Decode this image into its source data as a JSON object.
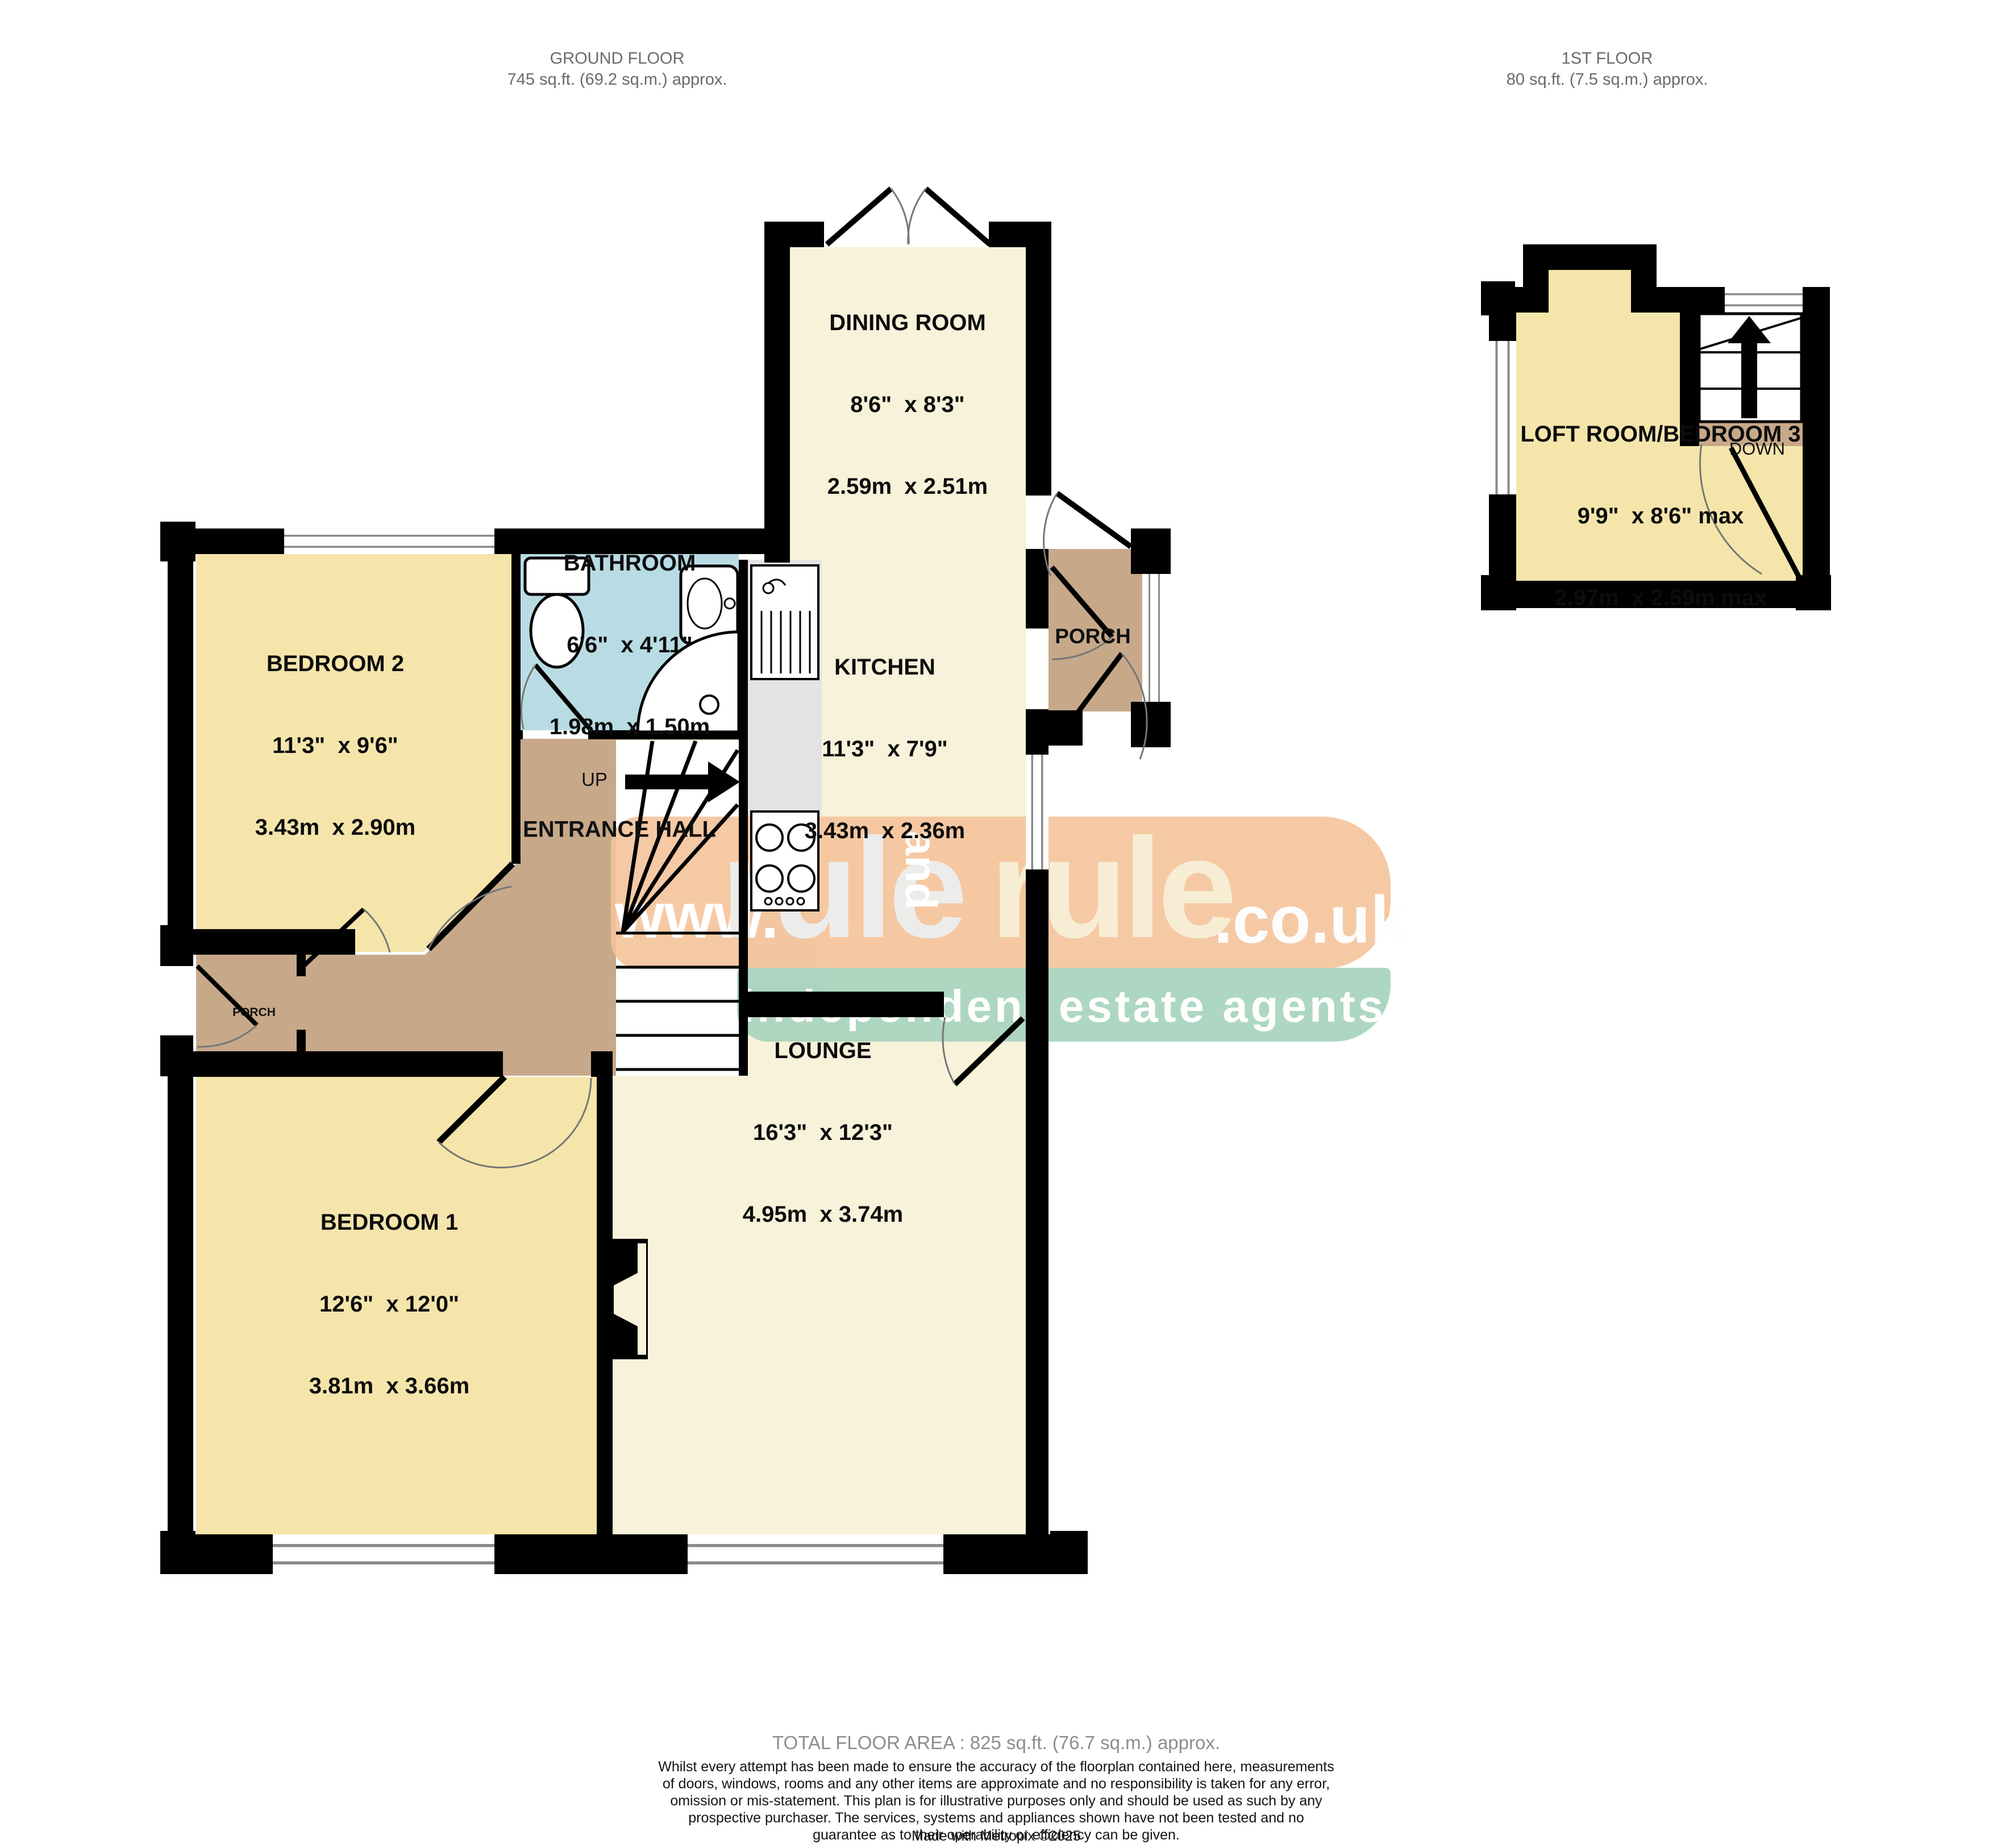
{
  "headers": {
    "ground": {
      "title": "GROUND FLOOR",
      "area": "745 sq.ft. (69.2 sq.m.) approx."
    },
    "first": {
      "title": "1ST FLOOR",
      "area": "80 sq.ft. (7.5 sq.m.) approx."
    }
  },
  "rooms": {
    "dining": {
      "name": "DINING ROOM",
      "imperial": "8'6\"  x 8'3\"",
      "metric": "2.59m  x 2.51m"
    },
    "kitchen": {
      "name": "KITCHEN",
      "imperial": "11'3\"  x 7'9\"",
      "metric": "3.43m  x 2.36m"
    },
    "bathroom": {
      "name": "BATHROOM",
      "imperial": "6'6\"  x 4'11\"",
      "metric": "1.98m  x 1.50m"
    },
    "bedroom2": {
      "name": "BEDROOM 2",
      "imperial": "11'3\"  x 9'6\"",
      "metric": "3.43m  x 2.90m"
    },
    "bedroom1": {
      "name": "BEDROOM 1",
      "imperial": "12'6\"  x 12'0\"",
      "metric": "3.81m  x 3.66m"
    },
    "lounge": {
      "name": "LOUNGE",
      "imperial": "16'3\"  x 12'3\"",
      "metric": "4.95m  x 3.74m"
    },
    "loft": {
      "name": "LOFT ROOM/BEDROOM 3",
      "imperial": "9'9\"  x 8'6\" max",
      "metric": "2.97m  x 2.59m max"
    },
    "entrance_hall": {
      "name": "ENTRANCE HALL"
    },
    "porch_right": {
      "name": "PORCH"
    },
    "porch_left": {
      "name": "PORCH"
    }
  },
  "stairs": {
    "up": "UP",
    "down": "DOWN"
  },
  "watermark": {
    "www": "www.",
    "rule1": "rule",
    "and": "and",
    "rule2": "rule",
    "domain": ".co.uk",
    "tagline": "independent estate agents"
  },
  "footer": {
    "total": "TOTAL FLOOR AREA : 825 sq.ft. (76.7 sq.m.) approx.",
    "disclaimer": "Whilst every attempt has been made to ensure the accuracy of the floorplan contained here, measurements of doors, windows, rooms and any other items are approximate and no responsibility is taken for any error, omission or mis-statement. This plan is for illustrative purposes only and should be used as such by any prospective purchaser. The services, systems and appliances shown have not been tested and no guarantee as to their operability or efficiency can be given.",
    "credit": "Made with Metropix ©2025"
  },
  "colors": {
    "wall": "#000000",
    "cream": "#f8f2da",
    "yellow": "#f5e5ab",
    "blue": "#b9dce4",
    "tan": "#c7a98a",
    "counter": "#e3e3e3",
    "winline": "#8a8a8a",
    "watermark_peach": "#f5c29a",
    "watermark_teal": "#a7d4be"
  },
  "icons": [
    "toilet-icon",
    "washbasin-icon",
    "shower-icon",
    "kitchen-sink-icon",
    "hob-icon",
    "stairs-up-arrow-icon",
    "stairs-down-arrow-icon",
    "fireplace-icon",
    "door-swing-icon",
    "window-icon"
  ]
}
